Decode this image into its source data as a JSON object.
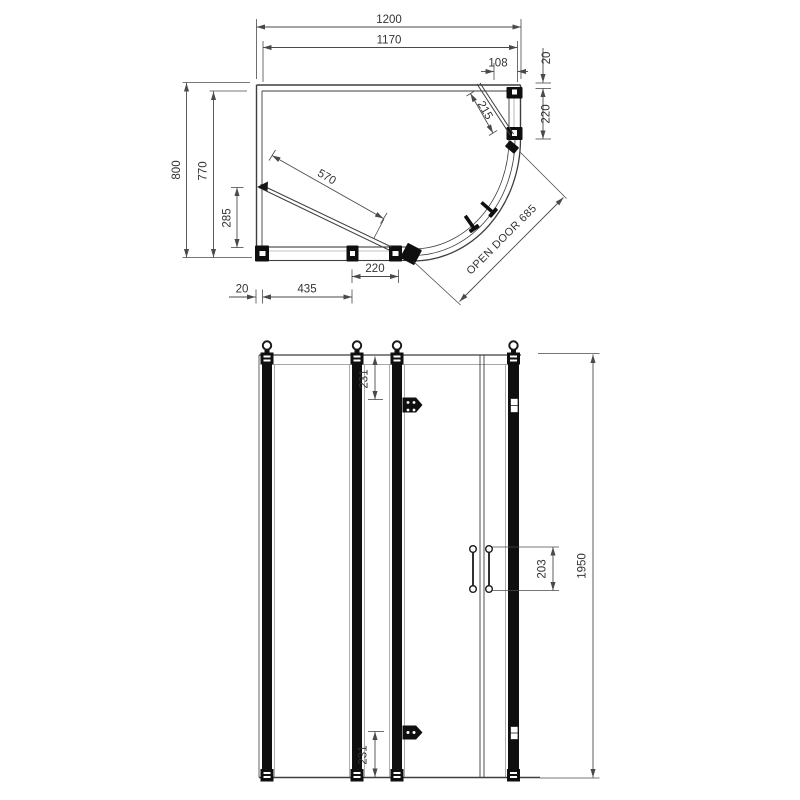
{
  "plan": {
    "dim_width_overall": "1200",
    "dim_width_glass": "1170",
    "dim_door_edge_gap": "108",
    "dim_wall_profile_top": "20",
    "dim_right_panel_depth": "220",
    "dim_door_clearance": "215",
    "dim_depth_overall": "800",
    "dim_depth_glass": "770",
    "dim_door_inswing": "285",
    "dim_door_width": "570",
    "dim_wall_profile_bottom": "20",
    "dim_front_panel": "435",
    "dim_front_door_gap": "220",
    "open_door_label": "OPEN DOOR 685"
  },
  "elevation": {
    "dim_hinge_from_top": "231",
    "dim_hinge_from_bottom": "231",
    "dim_handle_length": "203",
    "dim_height_overall": "1950"
  },
  "colors": {
    "line": "#4a4a4a",
    "frame": "#0f0f0f",
    "dim_text": "#333333",
    "background": "#ffffff"
  }
}
